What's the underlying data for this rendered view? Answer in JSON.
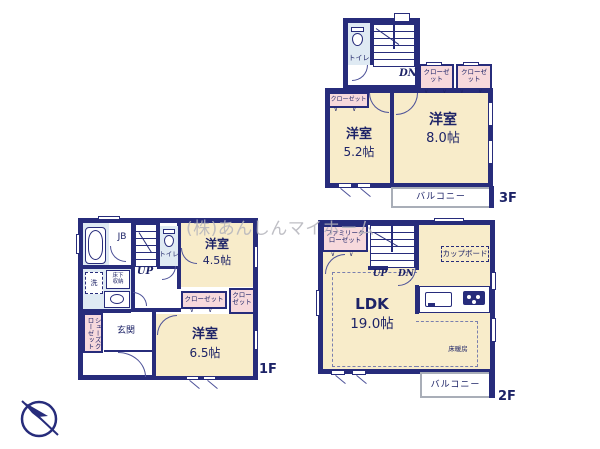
{
  "watermark": "(株)あんしんマイホーム",
  "colors": {
    "wall": "#272c7b",
    "room_fill": "#f8ecca",
    "closet_fill": "#f7d9dc",
    "wet_area_fill": "#dfeaf3",
    "watermark_gray": "#b4b4bc",
    "balcony_border": "#a9aeb8"
  },
  "symbols": {
    "door_mark": "∨ ∨"
  },
  "floors": {
    "f3": {
      "floor_label": "3F",
      "toilet": "トイレ",
      "stairs_dn": "DN",
      "closet_a": "クローゼット",
      "closet_b": "クローゼット",
      "closet_left": "クローゼット",
      "room_52_name": "洋室",
      "room_52_size": "5.2帖",
      "room_80_name": "洋室",
      "room_80_size": "8.0帖",
      "balcony": "バルコニー"
    },
    "f1": {
      "floor_label": "1F",
      "jb": "JB",
      "toilet": "トイレ",
      "stairs_up": "UP",
      "wash": "洗",
      "underfloor": "床下収納",
      "shoes_closet": "シューズクローゼット",
      "entrance": "玄関",
      "closet_a": "クローゼット",
      "closet_b": "クローゼット",
      "room_45_name": "洋室",
      "room_45_size": "4.5帖",
      "room_65_name": "洋室",
      "room_65_size": "6.5帖"
    },
    "f2": {
      "floor_label": "2F",
      "family_closet": "ファミリークローゼット",
      "stairs_up": "UP",
      "stairs_dn": "DN",
      "cupboard": "カップボード",
      "ldk_name": "LDK",
      "ldk_size": "19.0帖",
      "floor_heating": "床暖房",
      "balcony": "バルコニー"
    }
  }
}
